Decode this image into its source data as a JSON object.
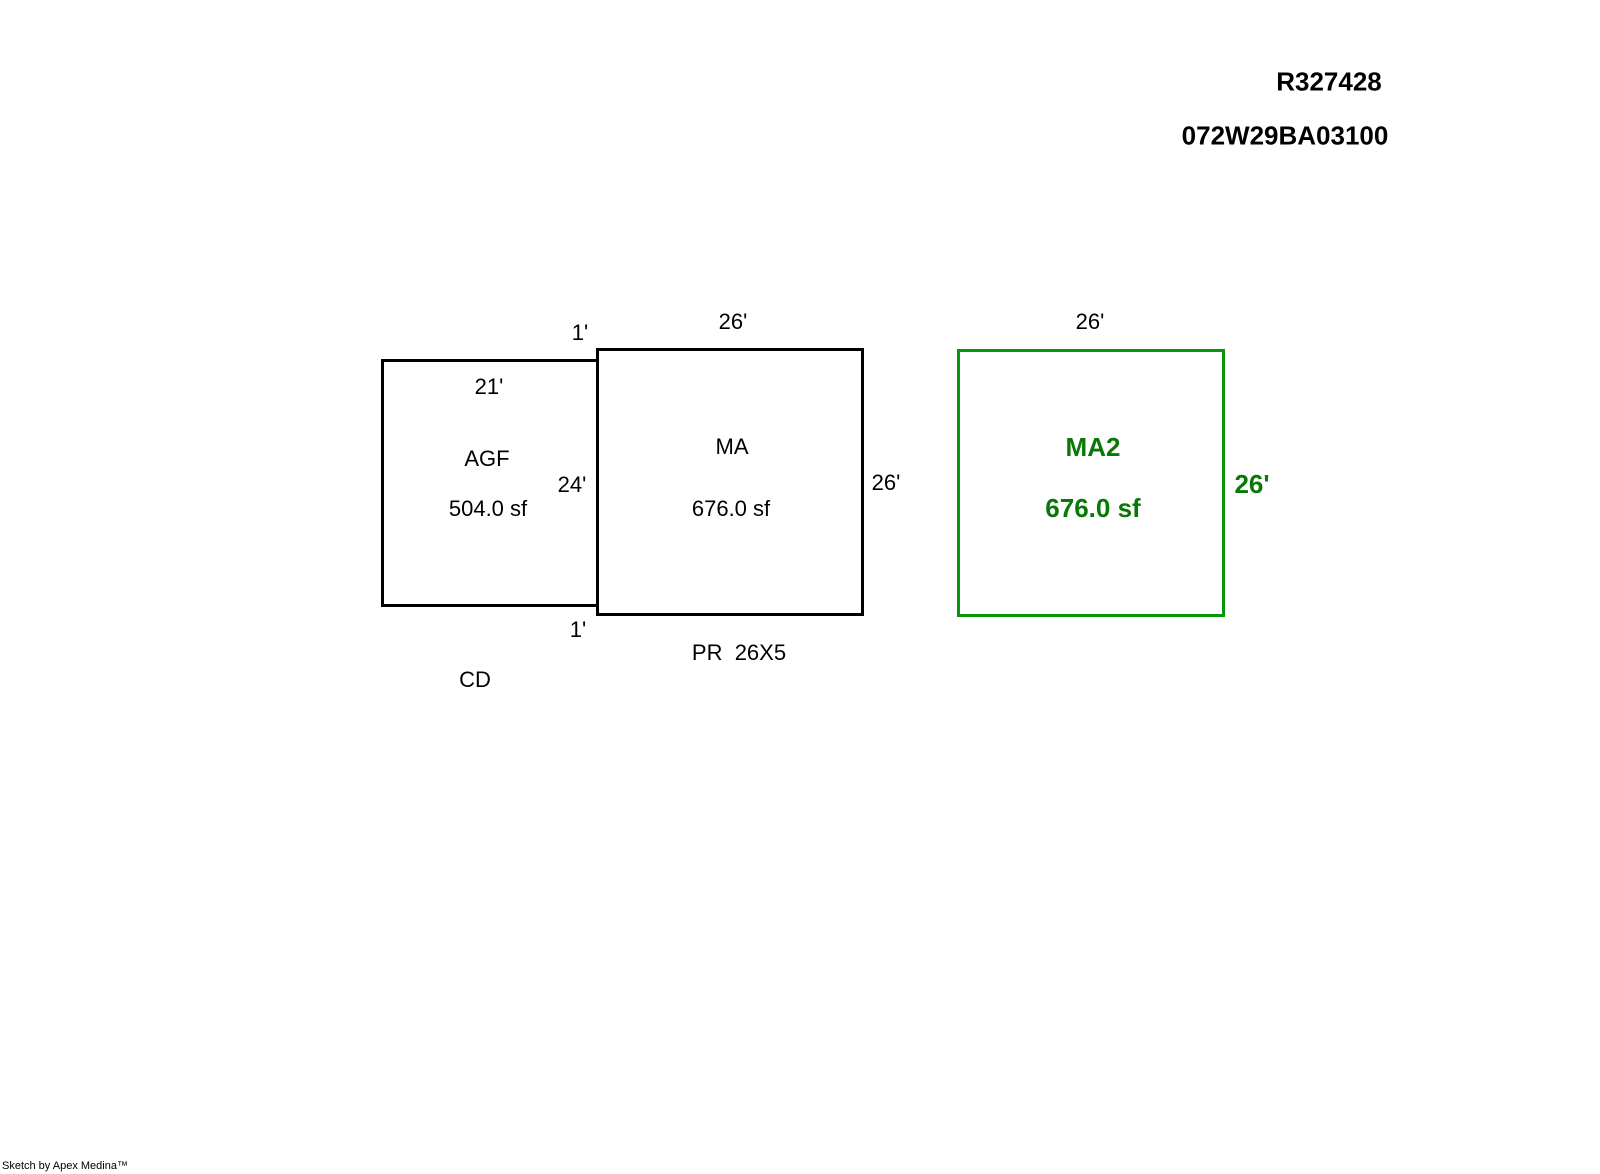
{
  "header": {
    "record_id": "R327428",
    "parcel_id": "072W29BA03100"
  },
  "sketch": {
    "agf": {
      "name": "AGF",
      "area": "504.0 sf",
      "top_dim": "21'",
      "right_dim": "24'"
    },
    "ma": {
      "name": "MA",
      "area": "676.0 sf",
      "top_dim": "26'",
      "right_dim": "26'"
    },
    "ma2": {
      "name": "MA2",
      "area": "676.0 sf",
      "top_dim": "26'",
      "right_dim": "26'"
    },
    "offset_top": "1'",
    "offset_bottom": "1'",
    "pr_note": "PR  26X5",
    "cd_note": "CD"
  },
  "colors": {
    "black_outline": "#000000",
    "green_outline": "#0a960a",
    "green_text": "#087808"
  },
  "footer": {
    "credit": "Sketch by Apex Medina™"
  }
}
